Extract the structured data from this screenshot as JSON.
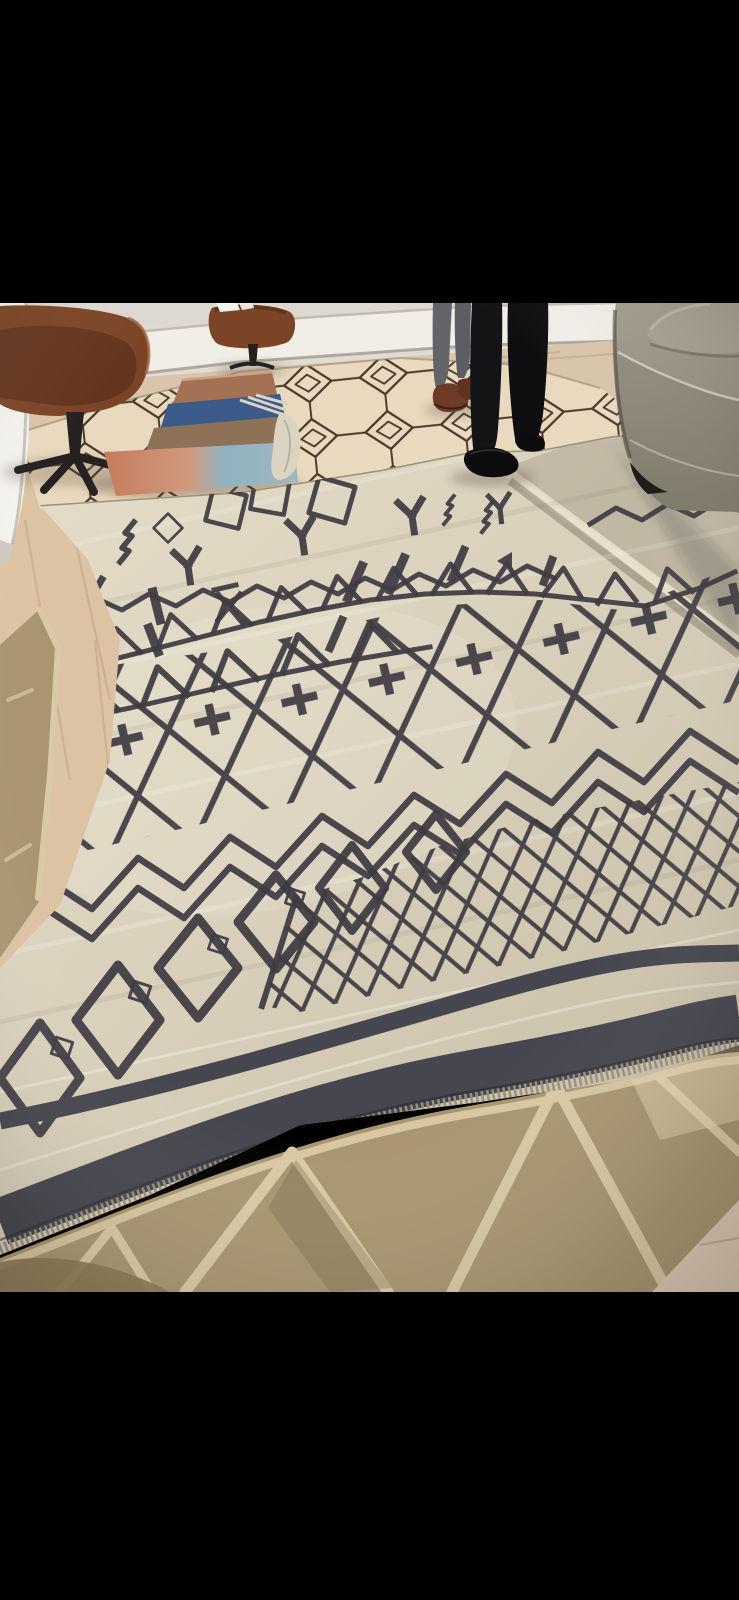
{
  "image": {
    "type": "photograph",
    "description": "Letterboxed photo of a rug showroom: a large cream flatweave kilim with charcoal geometric tribal motifs and navy border stripes unrolled over a tan flatweave rug; behind it a cream Moroccan diamond-pattern rug with a folded striped blanket, two brown leather swivel chairs, the legs of two standing people, and a greige linen sofa at right.",
    "letterbox_top_px": 303,
    "letterbox_bottom_px": 1292
  },
  "colors": {
    "bar": "#000000",
    "wall": "#dcd7d0",
    "wall_light": "#e9e5de",
    "baseboard": "#f1eee8",
    "baseboard_shadow": "#b9b2a8",
    "column": "#f4f2ee",
    "floor": "#d8c5ab",
    "floor_warm": "#dcc3a4",
    "moroccan_field": "#e9dabf",
    "moroccan_line": "#46382b",
    "kilim": "#d9d0bb",
    "kilim_light": "#e6deca",
    "kilim_dark": "#c7bda6",
    "kilim_motif": "#3e3b43",
    "kilim_navy": "#45464f",
    "kilim_fringe": "#99907e",
    "tan_rug": "#a99671",
    "tan_line": "#d9c9a4",
    "tan_olive": "#8b7a57",
    "wood_corner": "#dfccb6",
    "chair_leather": "#7b4426",
    "chair_leather_dark": "#522917",
    "chair_base": "#242120",
    "sofa": "#948e80",
    "sofa_light": "#a39d8e",
    "sofa_front": "#857f70",
    "sofa_piping": "#d3cdbd",
    "sofa_pillow": "#a8a191",
    "jeans": "#63656a",
    "shoe_brown": "#6e3b27",
    "person_dark": "#141417",
    "blanket_rose": "#a57155",
    "blanket_navy": "#3c5a8a",
    "blanket_taupe": "#8d7258",
    "blanket_salmon": "#c57c5c",
    "blanket_blue": "#8fb3c2",
    "blanket_cream": "#dbd4c1"
  }
}
